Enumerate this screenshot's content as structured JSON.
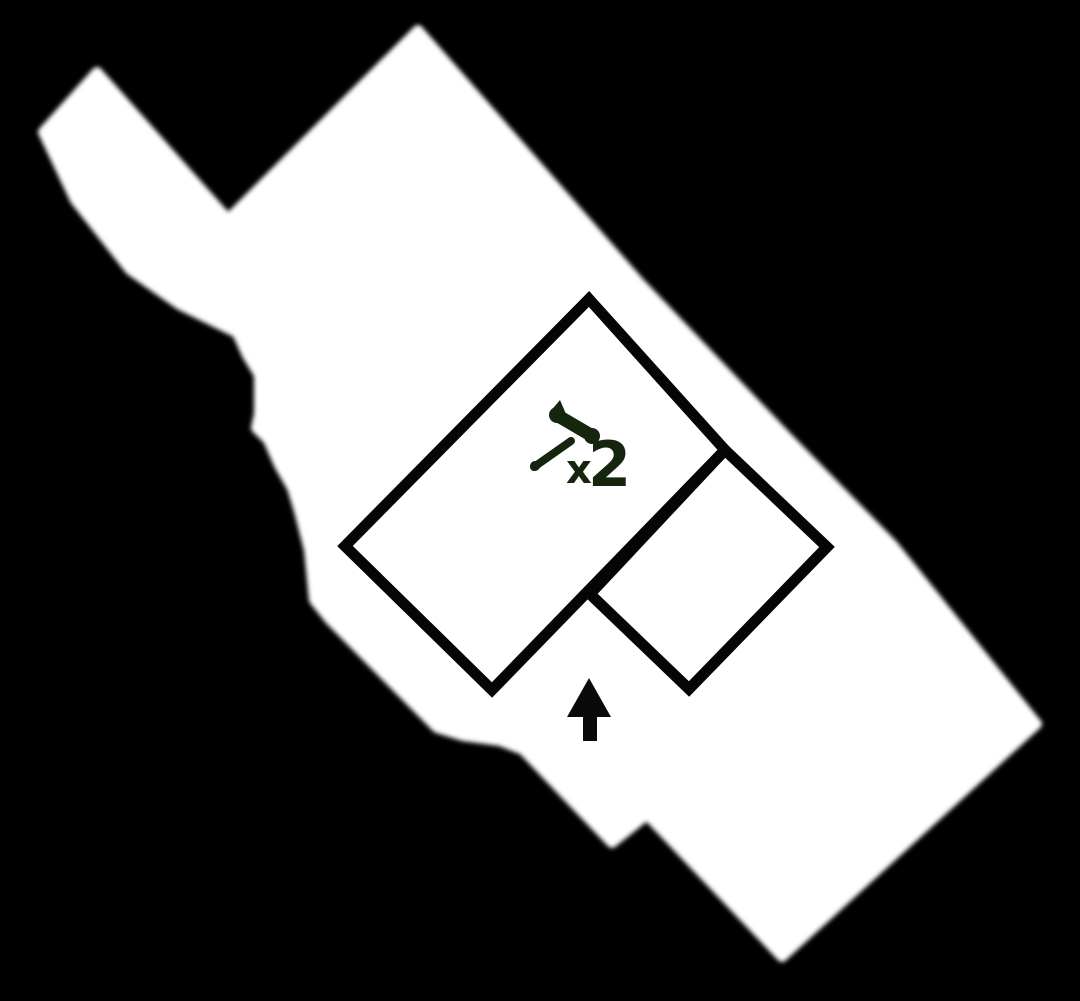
{
  "scene": {
    "background_color": "#000000"
  },
  "island": {
    "fill_color": "#ffffff",
    "outline_points": "97,72 228,219 418,30 640,283 790,440 893,545 1037,724 782,957 647,815 612,843 565,794 523,750 500,741 463,736 437,728 330,620 314,600 309,550 299,511 292,488 279,465 268,440 256,428 259,414 259,375 247,355 237,333 180,305 130,270 75,200 43,132",
    "speck_cx": 655,
    "speck_cy": 803
  },
  "buildings": {
    "outline_color": "#050505",
    "stroke_width": 11,
    "large_building_points": "589,299 725,450 492,690 345,546",
    "small_building_points": "725,450 827,547 689,689 590,594"
  },
  "entrance_arrow": {
    "color": "#0a0a0a",
    "points": "589,678 611,717 597,717 597,741 583,741 583,717 567,717"
  },
  "hammer_marker": {
    "color": "#16250e",
    "times_symbol": "x",
    "count": "2"
  }
}
